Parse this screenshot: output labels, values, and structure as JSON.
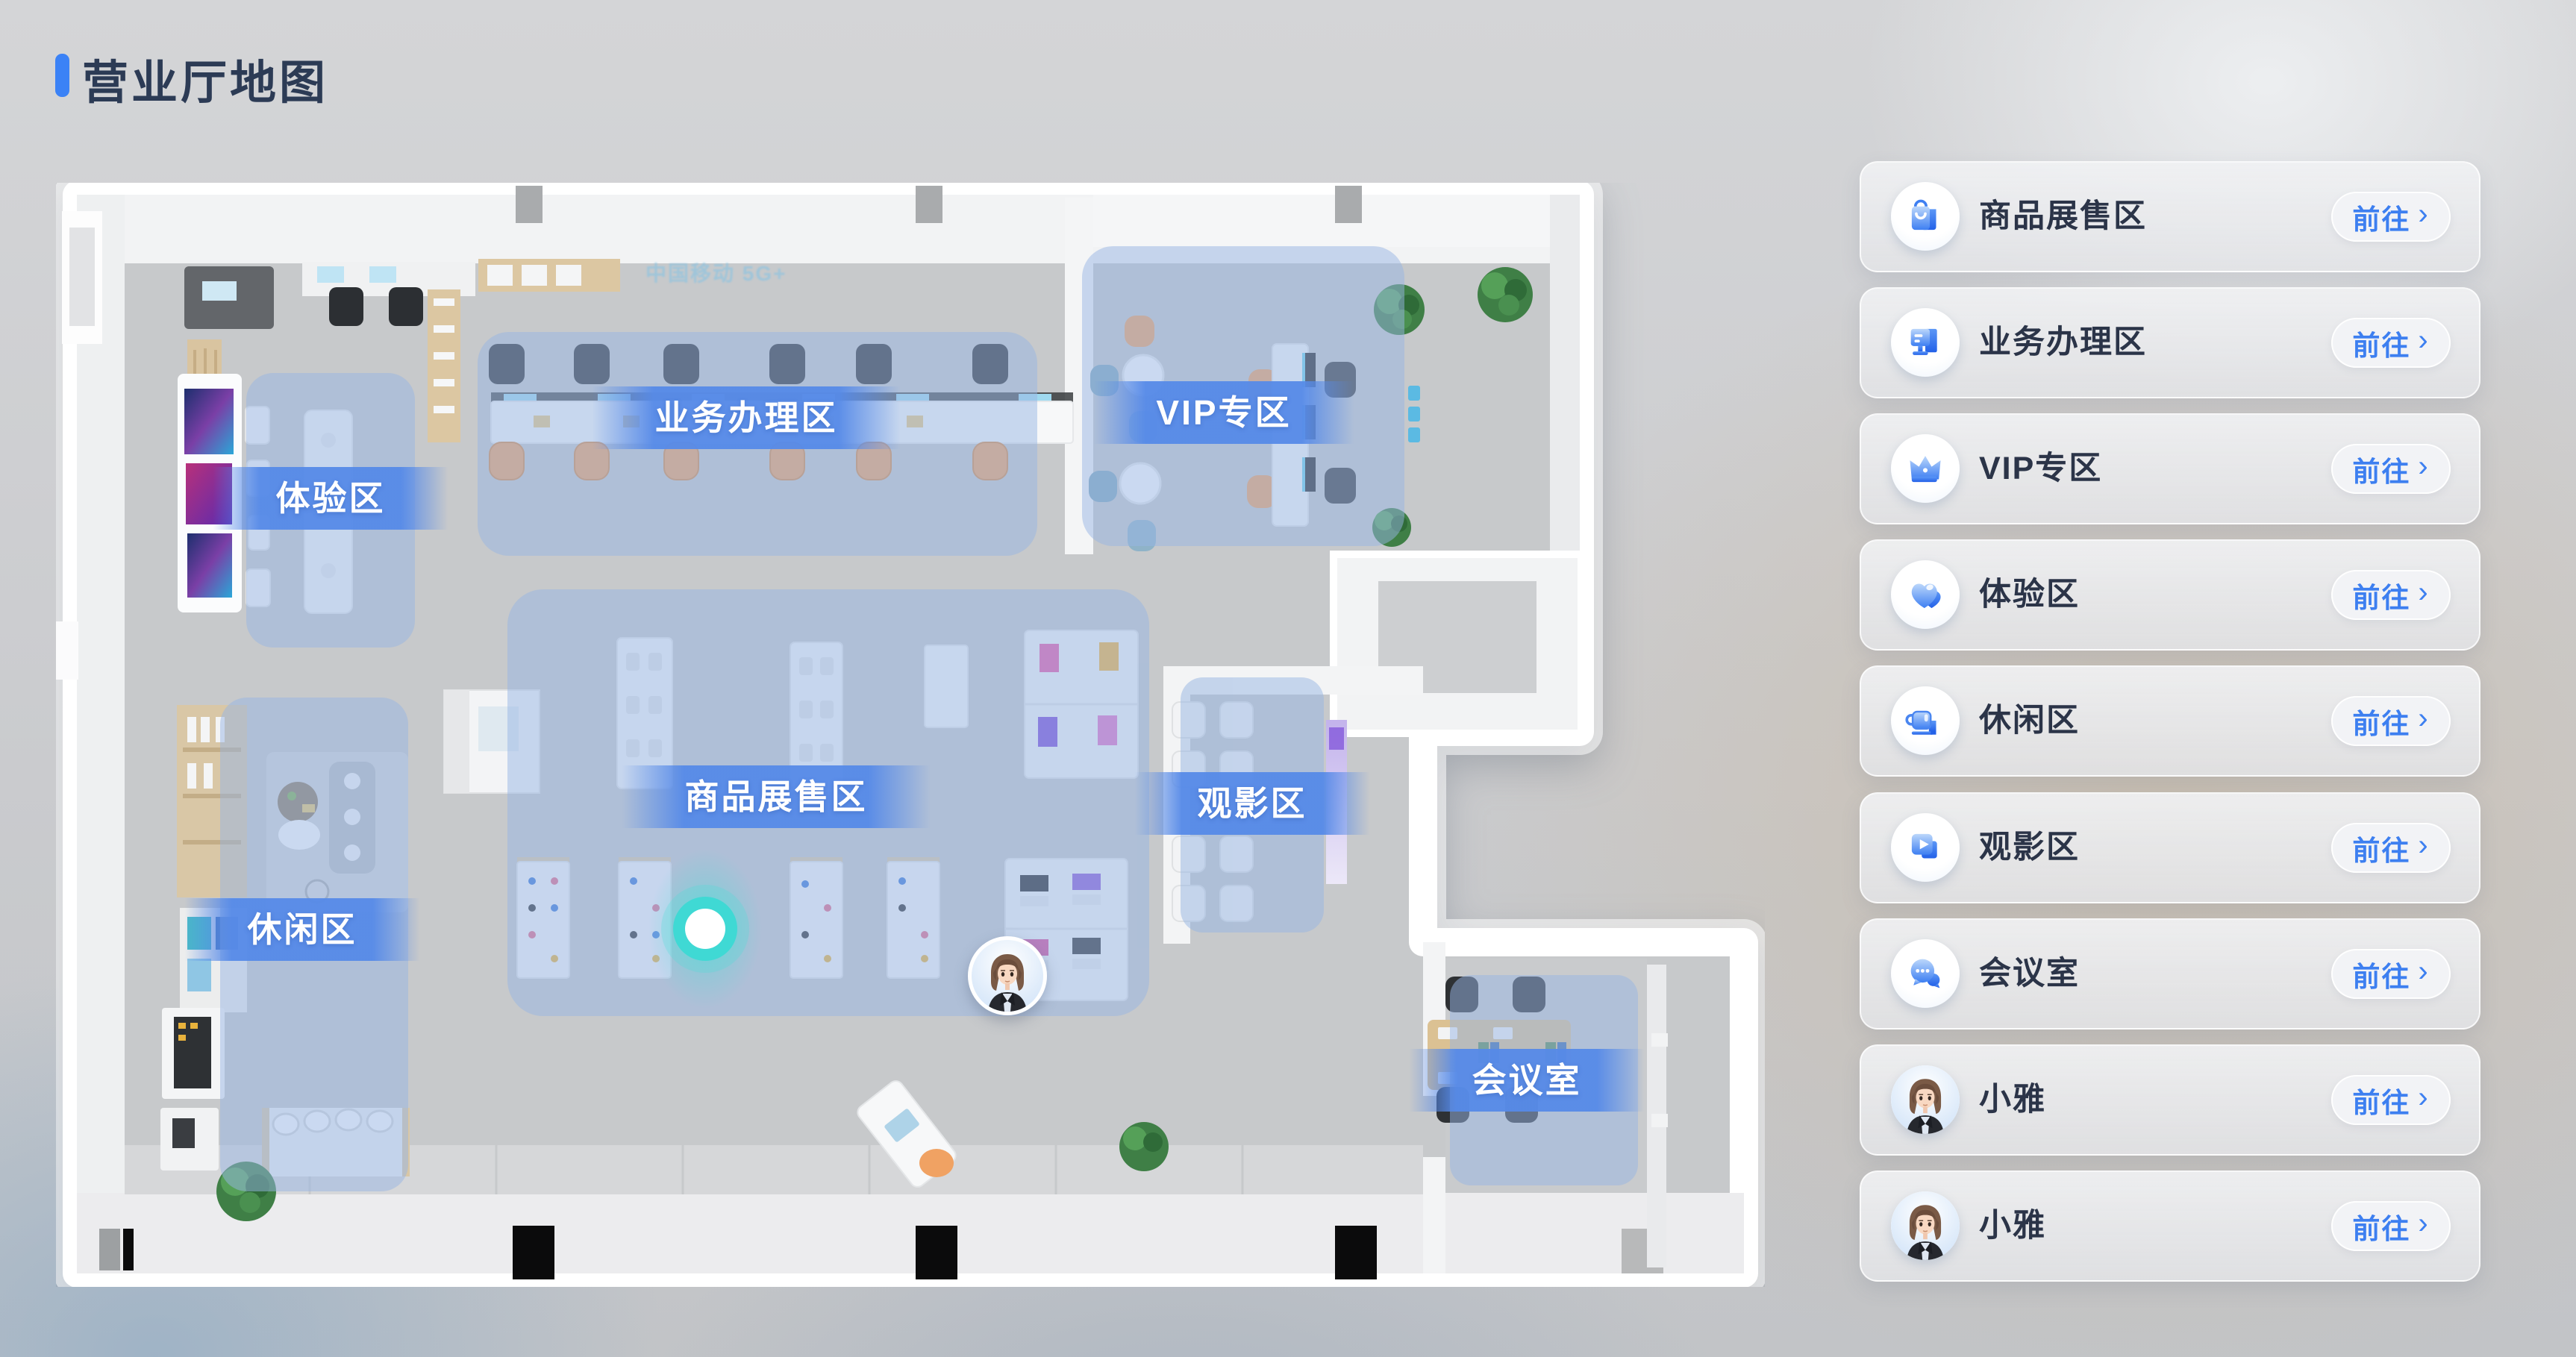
{
  "page": {
    "title": "营业厅地图"
  },
  "map": {
    "wall_sign": "中国移动 5G+",
    "zones": [
      {
        "id": "business",
        "label": "业务办理区"
      },
      {
        "id": "vip",
        "label": "VIP专区"
      },
      {
        "id": "experience",
        "label": "体验区"
      },
      {
        "id": "shop",
        "label": "商品展售区"
      },
      {
        "id": "cinema",
        "label": "观影区"
      },
      {
        "id": "leisure",
        "label": "休闲区"
      },
      {
        "id": "meeting",
        "label": "会议室"
      }
    ]
  },
  "sidebar": {
    "go_label": "前往",
    "go_chevron": "›",
    "items": [
      {
        "label": "商品展售区",
        "icon": "shopping-bag-icon"
      },
      {
        "label": "业务办理区",
        "icon": "business-terminal-icon"
      },
      {
        "label": "VIP专区",
        "icon": "crown-icon"
      },
      {
        "label": "体验区",
        "icon": "hearts-icon"
      },
      {
        "label": "休闲区",
        "icon": "coffee-cup-icon"
      },
      {
        "label": "观影区",
        "icon": "video-play-icon"
      },
      {
        "label": "会议室",
        "icon": "chat-bubbles-icon"
      },
      {
        "label": "小雅",
        "icon": "xiaoya-avatar"
      },
      {
        "label": "小雅",
        "icon": "xiaoya-avatar"
      }
    ]
  },
  "colors": {
    "accent": "#3D7FF0",
    "title": "#2C3B55",
    "zone_overlay": "#97B6E3",
    "label_band": "#5688E8",
    "marker": "#3FD9D4"
  }
}
